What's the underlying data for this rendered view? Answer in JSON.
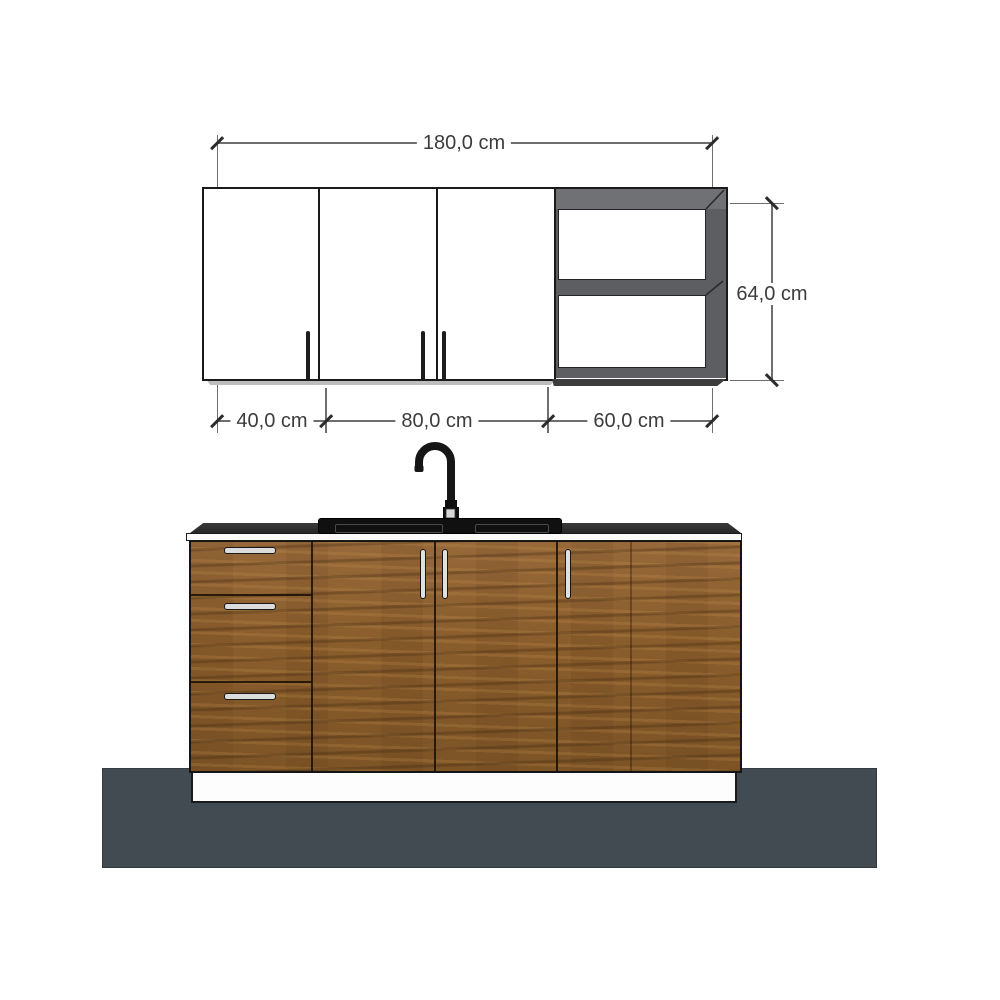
{
  "title": "Kitchen cabinet set - dimensioned front elevation",
  "dimensions": {
    "total_width": {
      "label": "180,0 cm"
    },
    "upper_height": {
      "label": "64,0 cm"
    },
    "sections": [
      {
        "label": "40,0 cm"
      },
      {
        "label": "80,0 cm"
      },
      {
        "label": "60,0 cm"
      }
    ]
  },
  "elements": {
    "upper_cabinet": {
      "doors": 3,
      "open_shelf_compartments": 2
    },
    "lower_cabinet": {
      "drawers": 3,
      "doors": 3
    },
    "fixtures": [
      "gooseneck-faucet",
      "sink"
    ]
  },
  "colors": {
    "background": "#ffffff",
    "floor": "#434b52",
    "wood": "#8f6130",
    "counter_top": "#2f2f2f",
    "cabinet_white": "#ffffff",
    "shelf_frame": "#5d5e62",
    "outline": "#1a1a1a",
    "dimension_line": "#6e6e6e",
    "dimension_text": "#3c3c3c"
  }
}
